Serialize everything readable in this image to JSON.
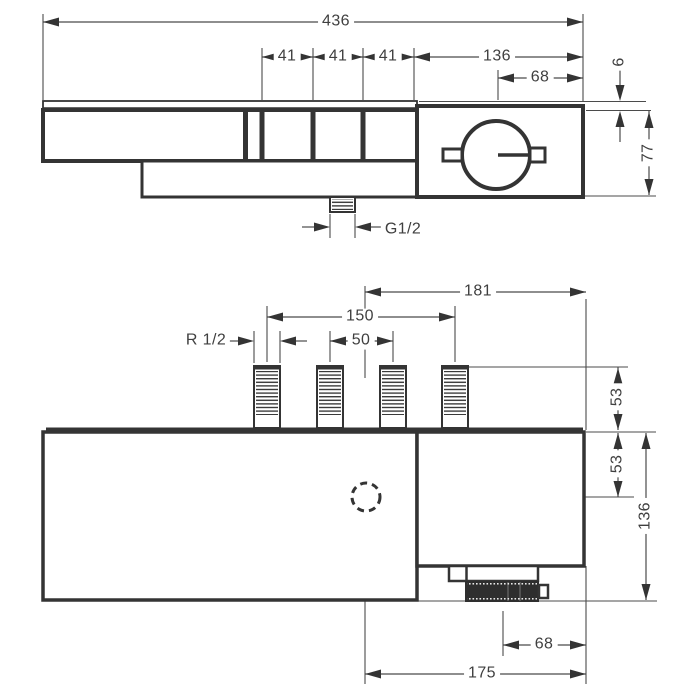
{
  "drawing": {
    "type": "technical dimension drawing, two orthographic views of a thermostatic shower mixer",
    "colors": {
      "outline": "#343434",
      "dimension_line": "#4b4b4b",
      "text": "#3f3f3f",
      "background": "#ffffff",
      "knob_fill": "#2e2e2e"
    }
  },
  "front_view": {
    "total_width": "436",
    "spacings": [
      "41",
      "41",
      "41"
    ],
    "right_section_width": "136",
    "handle_center_offset": "68",
    "plate_thickness": "6",
    "body_height": "77",
    "outlet_thread": "G1/2"
  },
  "plan_view": {
    "inlet_thread": "R 1/2",
    "center_to_right_edge": "181",
    "outer_pipe_span": "150",
    "inner_pipe_span": "50",
    "pipe_height": "53",
    "center_depth": "53",
    "total_depth": "136",
    "knob_center_offset": "68",
    "center_to_edge_lower": "175"
  }
}
